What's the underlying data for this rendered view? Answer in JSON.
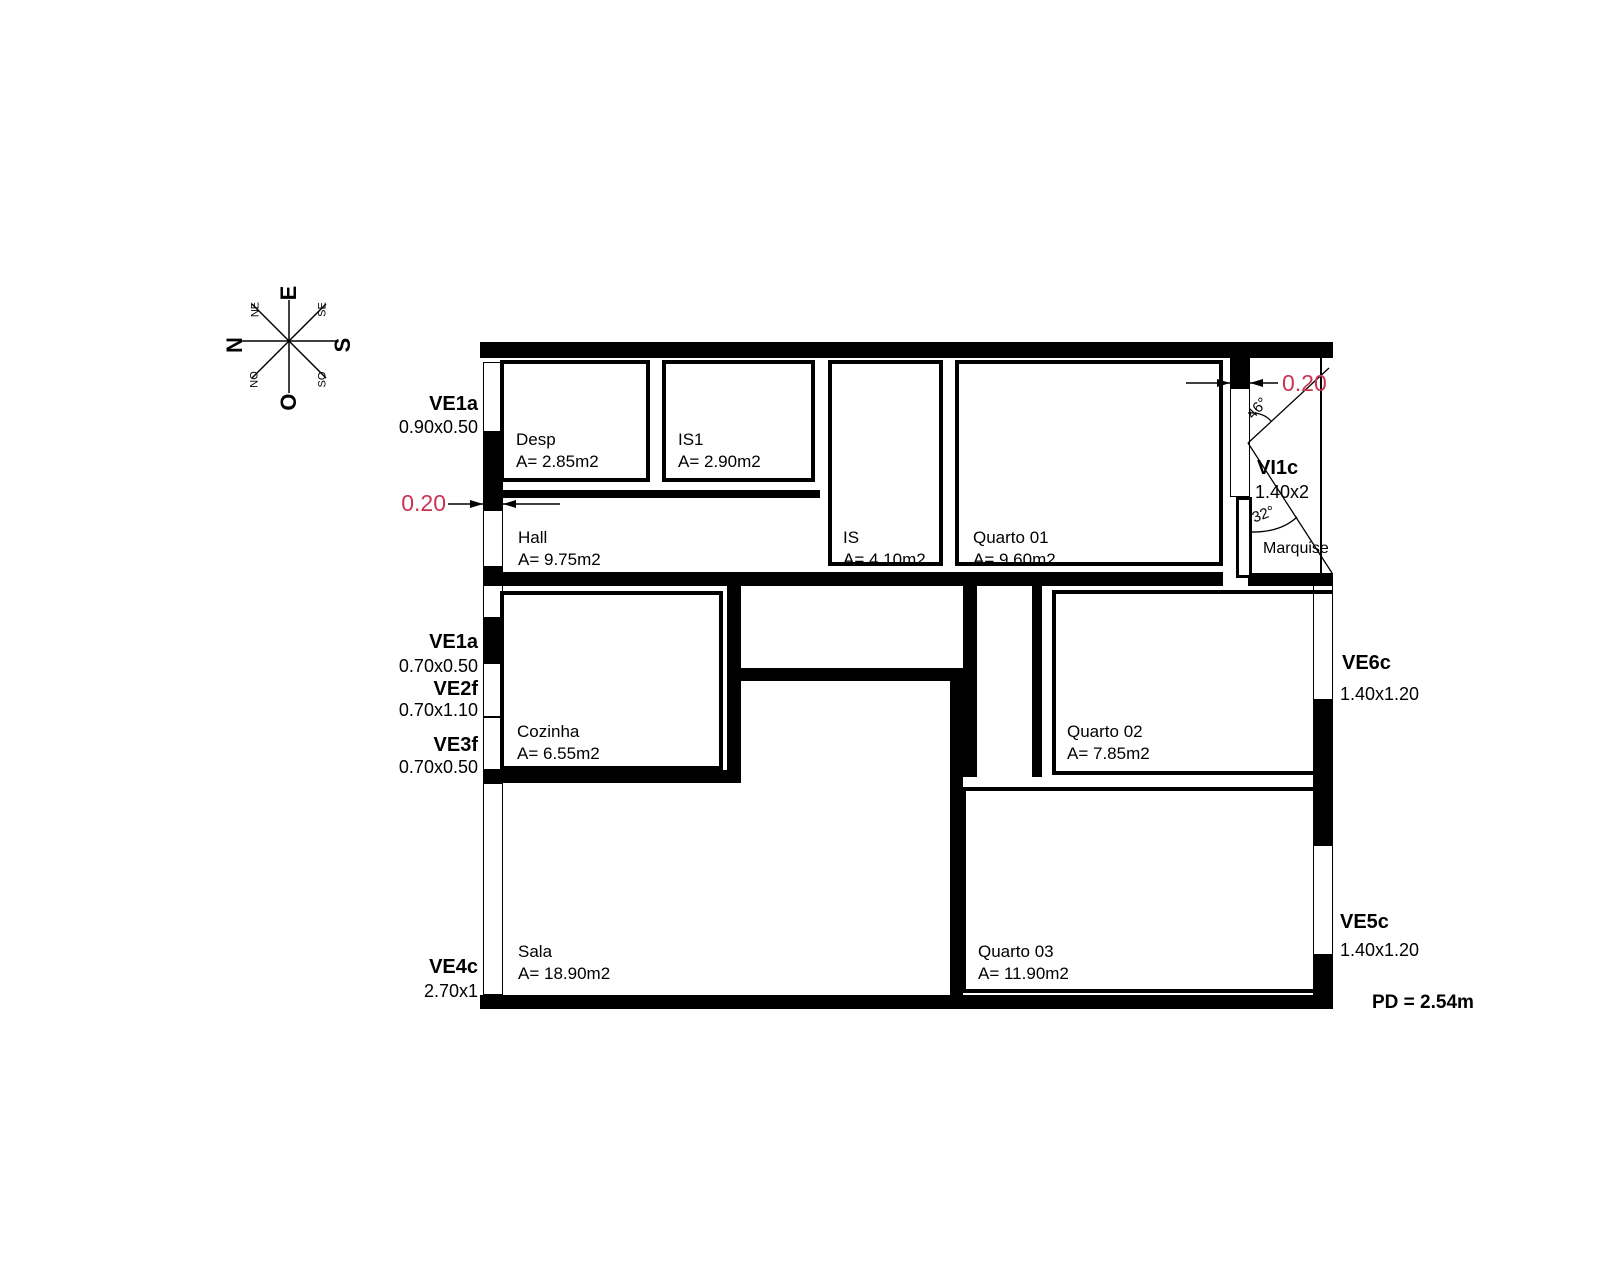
{
  "drawing": {
    "compass": {
      "e": "E",
      "s": "S",
      "n": "N",
      "o": "O",
      "ne": "NE",
      "se": "SE",
      "no": "NO",
      "so": "SO"
    },
    "rooms": {
      "desp": {
        "name": "Desp",
        "area": "A= 2.85m2"
      },
      "is1": {
        "name": "IS1",
        "area": "A= 2.90m2"
      },
      "is": {
        "name": "IS",
        "area": "A= 4.10m2"
      },
      "quarto01": {
        "name": "Quarto 01",
        "area": "A= 9.60m2"
      },
      "hall": {
        "name": "Hall",
        "area": "A= 9.75m2"
      },
      "cozinha": {
        "name": "Cozinha",
        "area": "A= 6.55m2"
      },
      "quarto02": {
        "name": "Quarto 02",
        "area": "A= 7.85m2"
      },
      "sala": {
        "name": "Sala",
        "area": "A= 18.90m2"
      },
      "quarto03": {
        "name": "Quarto 03",
        "area": "A= 11.90m2"
      },
      "marquise": {
        "name": "Marquise"
      }
    },
    "openings": {
      "ve1a_top": {
        "code": "VE1a",
        "size": "0.90x0.50"
      },
      "ve1a_mid": {
        "code": "VE1a",
        "size": "0.70x0.50"
      },
      "ve2f": {
        "code": "VE2f",
        "size": "0.70x1.10"
      },
      "ve3f": {
        "code": "VE3f",
        "size": "0.70x0.50"
      },
      "ve4c": {
        "code": "VE4c",
        "size": "2.70x1"
      },
      "ve6c": {
        "code": "VE6c",
        "size": "1.40x1.20"
      },
      "ve5c": {
        "code": "VE5c",
        "size": "1.40x1.20"
      },
      "vi1c": {
        "code": "VI1c",
        "size": "1.40x2"
      }
    },
    "annotations": {
      "wall_dim_left": "0.20",
      "wall_dim_top": "0.20",
      "angle_upper": "46°",
      "angle_lower": "32°",
      "ceiling_height": "PD = 2.54m"
    },
    "colors": {
      "line": "#000000",
      "dimension": "#cc3352",
      "background": "#ffffff"
    }
  }
}
